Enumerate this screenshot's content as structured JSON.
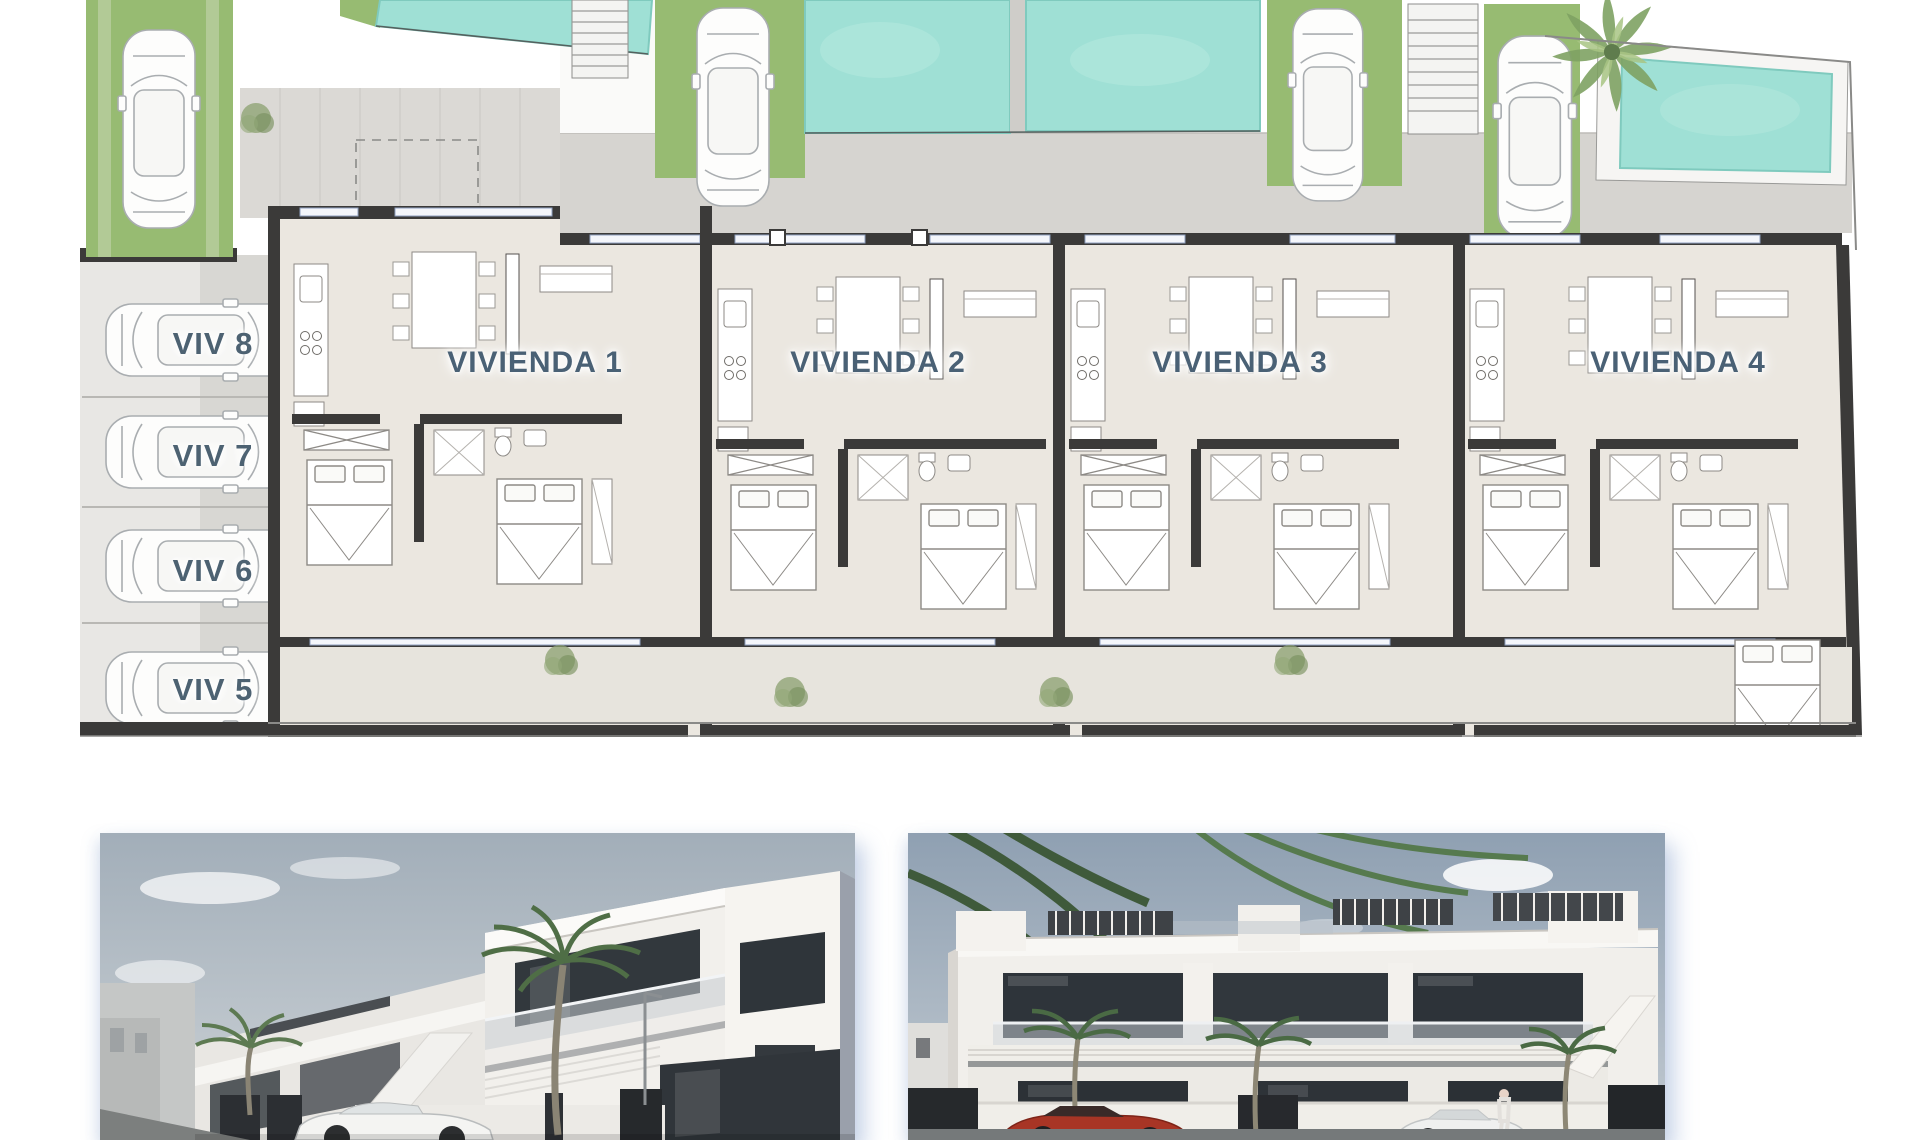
{
  "plan": {
    "unit_labels": [
      {
        "text": "VIVIENDA 1"
      },
      {
        "text": "VIVIENDA 2"
      },
      {
        "text": "VIVIENDA 3"
      },
      {
        "text": "VIVIENDA 4"
      }
    ],
    "parking_labels": [
      {
        "text": "VIV 8"
      },
      {
        "text": "VIV 7"
      },
      {
        "text": "VIV 6"
      },
      {
        "text": "VIV 5"
      }
    ],
    "colors": {
      "pool": "#9fe0d5",
      "pool_edge": "#7fcabe",
      "grass": "#97bb72",
      "wall": "#3b3a39",
      "floor": "#ebe7e0",
      "terrace": "#d6d4d0",
      "patio": "#dbd9d5",
      "rear_terrace": "#e7e4dd",
      "parking_light": "#e8e7e4",
      "parking_dark": "#d8d7d3",
      "label_text": "#4a6175"
    }
  },
  "renders": {
    "colors": {
      "sky_left": "#a2aeb9",
      "sky_right": "#8fa0b2",
      "building_white": "#f2f0ec",
      "glass_dark": "#2e343a",
      "fence_dark": "#26292c",
      "red_car": "#a83525",
      "white_car": "#eff0ef",
      "palm_green": "#4a6a44",
      "road": "#75797a"
    }
  }
}
